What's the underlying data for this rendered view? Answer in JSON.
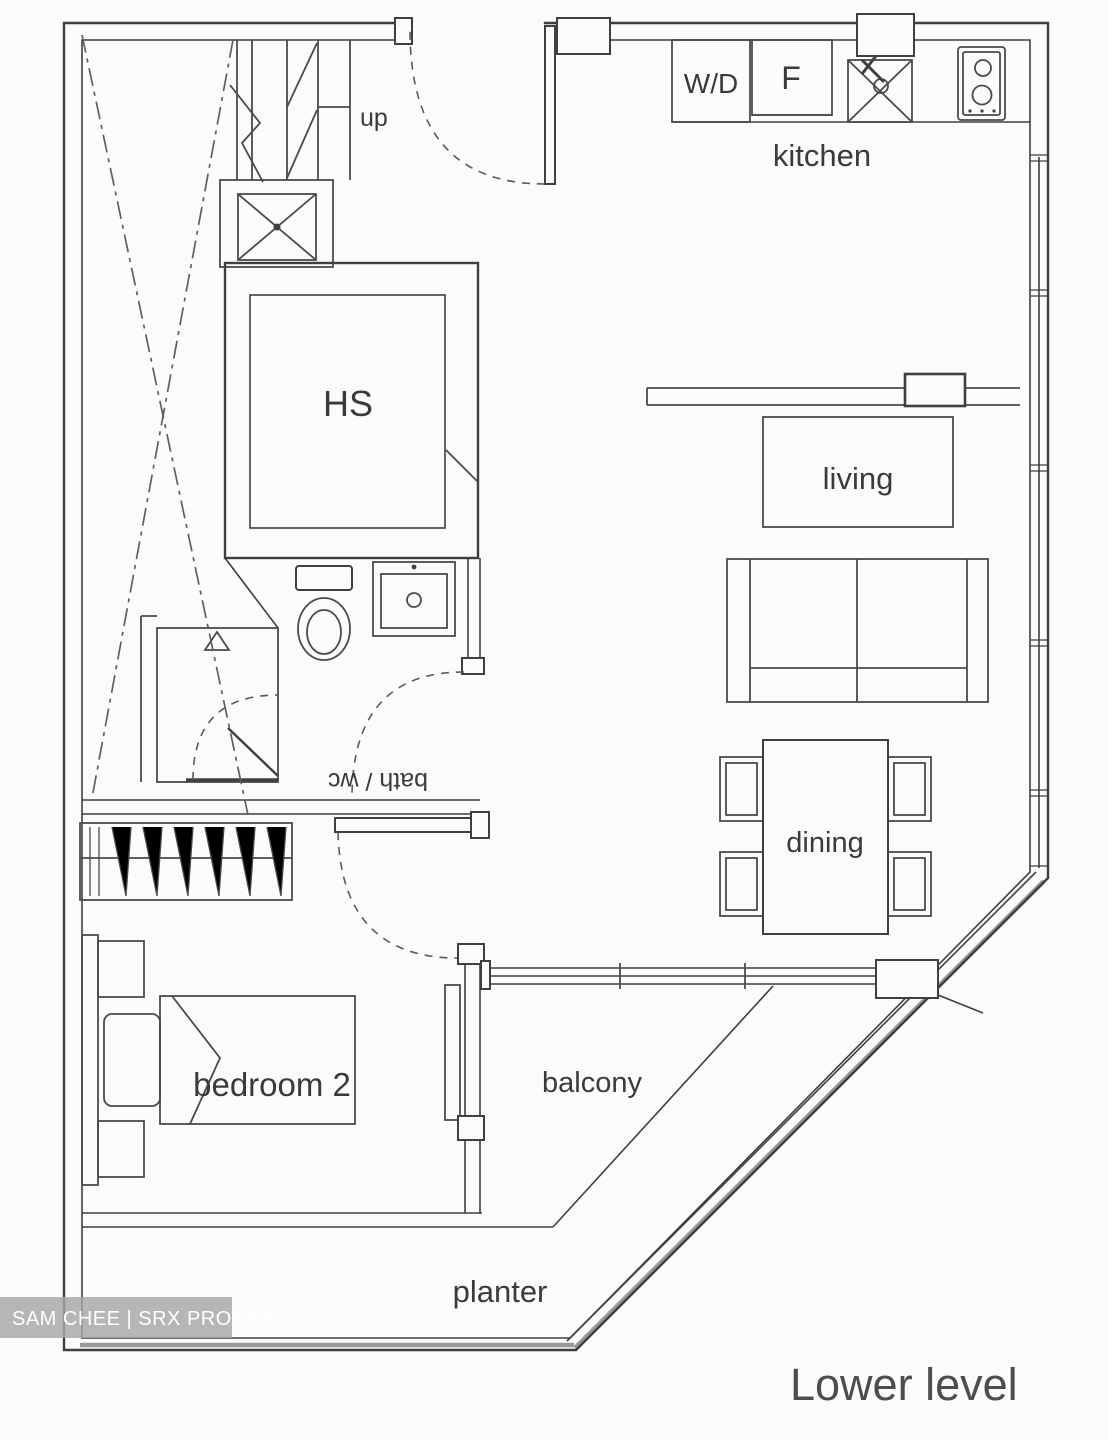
{
  "plan": {
    "title": "Lower level",
    "watermark": "SAM CHEE | SRX PROPERTY",
    "rooms": {
      "kitchen": {
        "label": "kitchen"
      },
      "living": {
        "label": "living"
      },
      "dining": {
        "label": "dining"
      },
      "bedroom2": {
        "label": "bedroom 2"
      },
      "balcony": {
        "label": "balcony"
      },
      "planter": {
        "label": "planter"
      },
      "household_shelter": {
        "label": "HS"
      },
      "bath": {
        "label": "bath / wc",
        "orientation": "upside-down"
      }
    },
    "appliances": {
      "washer_dryer": "W/D",
      "fridge": "F"
    },
    "annotations": {
      "stairs_direction": "up"
    },
    "colors": {
      "line": "#3f3f3f",
      "text": "#3a3a3a",
      "title_text": "#4d4d4d",
      "watermark_bg": "#a6a6a6",
      "watermark_text": "#ffffff",
      "background": "#fbfbf9",
      "railing_gray": "#999999"
    }
  }
}
